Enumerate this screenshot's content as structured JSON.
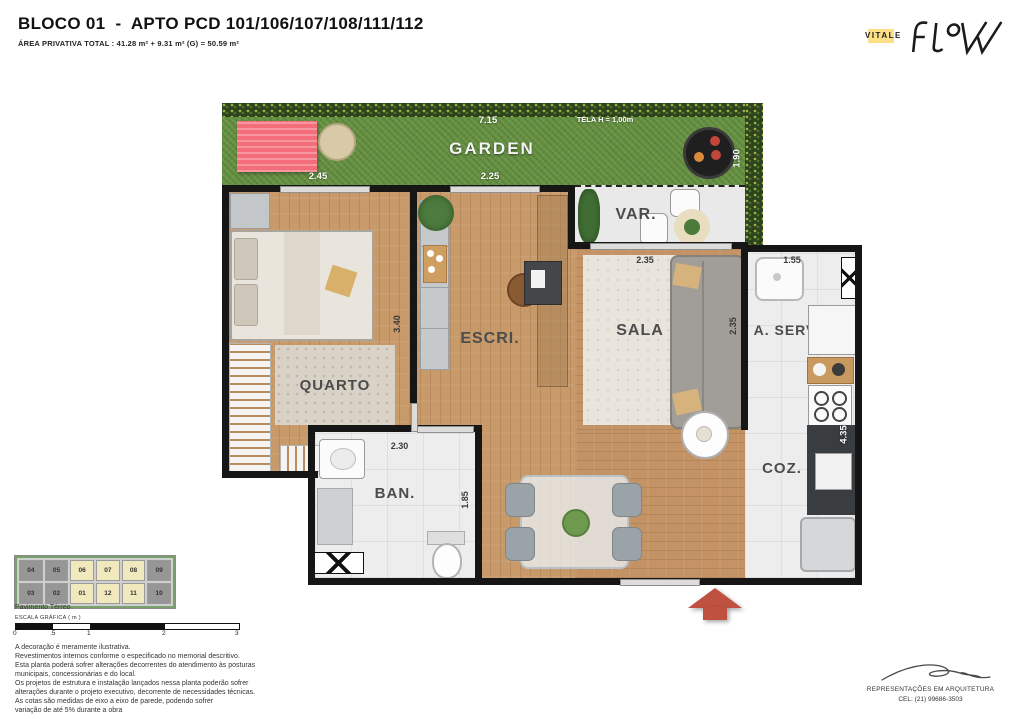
{
  "header": {
    "title": "BLOCO 01  -  APTO PCD 101/106/107/108/111/112",
    "subtitle": "ÁREA PRIVATIVA TOTAL : 41.28 m² + 9.31 m² (G) = 50.59 m²"
  },
  "brand": {
    "vitale": "VITALE",
    "flow": "FLOW"
  },
  "plan": {
    "rooms": {
      "garden": "GARDEN",
      "varanda": "VAR.",
      "quarto": "QUARTO",
      "escritorio": "ESCRI.",
      "sala": "SALA",
      "area_servico": "A. SERV",
      "banheiro": "BAN.",
      "cozinha": "COZ."
    },
    "dims": {
      "garden_width": "7.15",
      "tela": "TELA H = 1,00m",
      "garden_depth": "1.90",
      "quarto_width": "2.45",
      "escri_width": "2.25",
      "quarto_depth": "3.40",
      "sala_width": "2.35",
      "sala_depth": "2.35",
      "aserv_width": "1.55",
      "ban_width": "2.30",
      "ban_depth": "1.85",
      "coz_depth": "4.35"
    }
  },
  "keyplan": {
    "floor_label": "Pavimento Térreo",
    "scale_label": "ESCALA GRÁFICA ( m )",
    "scale_ticks": [
      "0",
      ".5",
      "1",
      "2",
      "3"
    ],
    "row1": [
      {
        "n": "04"
      },
      {
        "n": "05"
      },
      {
        "n": "06"
      },
      {
        "n": "07"
      },
      {
        "n": "08"
      },
      {
        "n": "09"
      }
    ],
    "row2": [
      {
        "n": "03"
      },
      {
        "n": "02"
      },
      {
        "n": "01"
      },
      {
        "n": "12"
      },
      {
        "n": "11"
      },
      {
        "n": "10"
      }
    ]
  },
  "disclaimer": {
    "lines": [
      "A decoração é meramente ilustrativa.",
      "Revestimentos internos conforme o especificado no memorial descritivo.",
      "Esta planta poderá sofrer alterações decorrentes do atendimento às posturas",
      "municipais, concessionárias e do local.",
      "Os projetos de estrutura e instalação lançados nessa planta poderão sofrer",
      "alterações durante o projeto executivo, decorrente de necessidades técnicas.",
      "As cotas são medidas de eixo a eixo de parede, podendo sofrer",
      "variação de até 5% durante a obra"
    ]
  },
  "footer": {
    "firm": "REPRESENTAÇÕES EM ARQUITETURA",
    "phone": "CEL: (21) 99686-3503"
  }
}
